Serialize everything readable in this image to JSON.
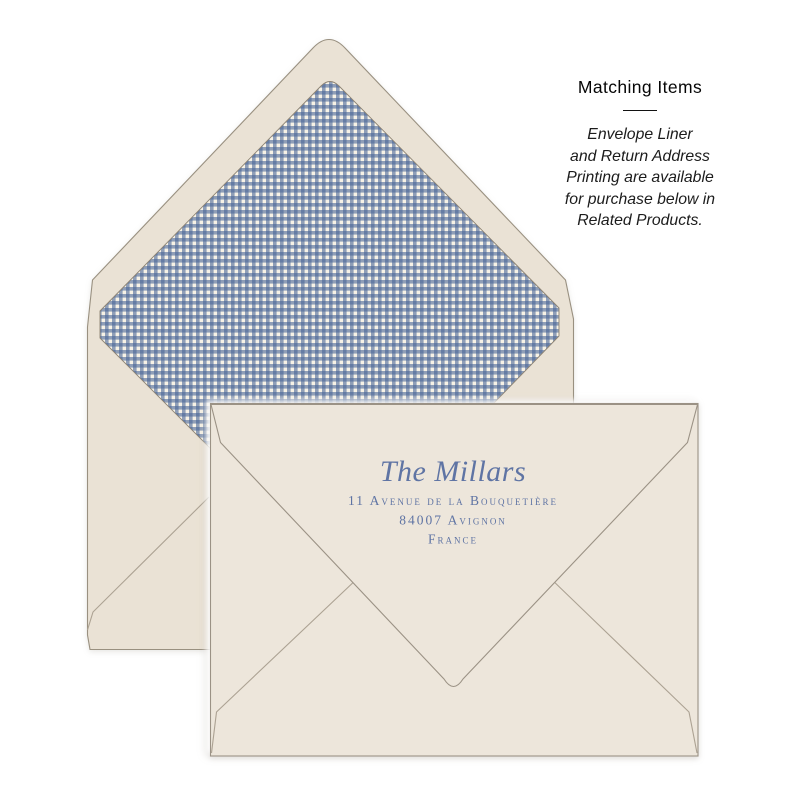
{
  "matching_items": {
    "heading": "Matching Items",
    "body_lines": [
      "Envelope Liner",
      "and Return Address",
      "Printing are available",
      "for purchase below in",
      "Related Products."
    ]
  },
  "envelope_front": {
    "return_address": {
      "name": "The Millars",
      "street": "11 Avenue de la Bouquetière",
      "city": "84007 Avignon",
      "country": "France"
    }
  },
  "envelope_back": {
    "liner_pattern": "blue-gingham"
  },
  "colors": {
    "back_paper": "#EAE2D5",
    "front_paper": "#EDE6DB",
    "outline": "#999080",
    "crease": "#ACA293",
    "liner_blue": "#4A6698",
    "liner_cream": "#F7F2E6",
    "address_text": "#5F74A4",
    "heading_text": "#060606"
  }
}
